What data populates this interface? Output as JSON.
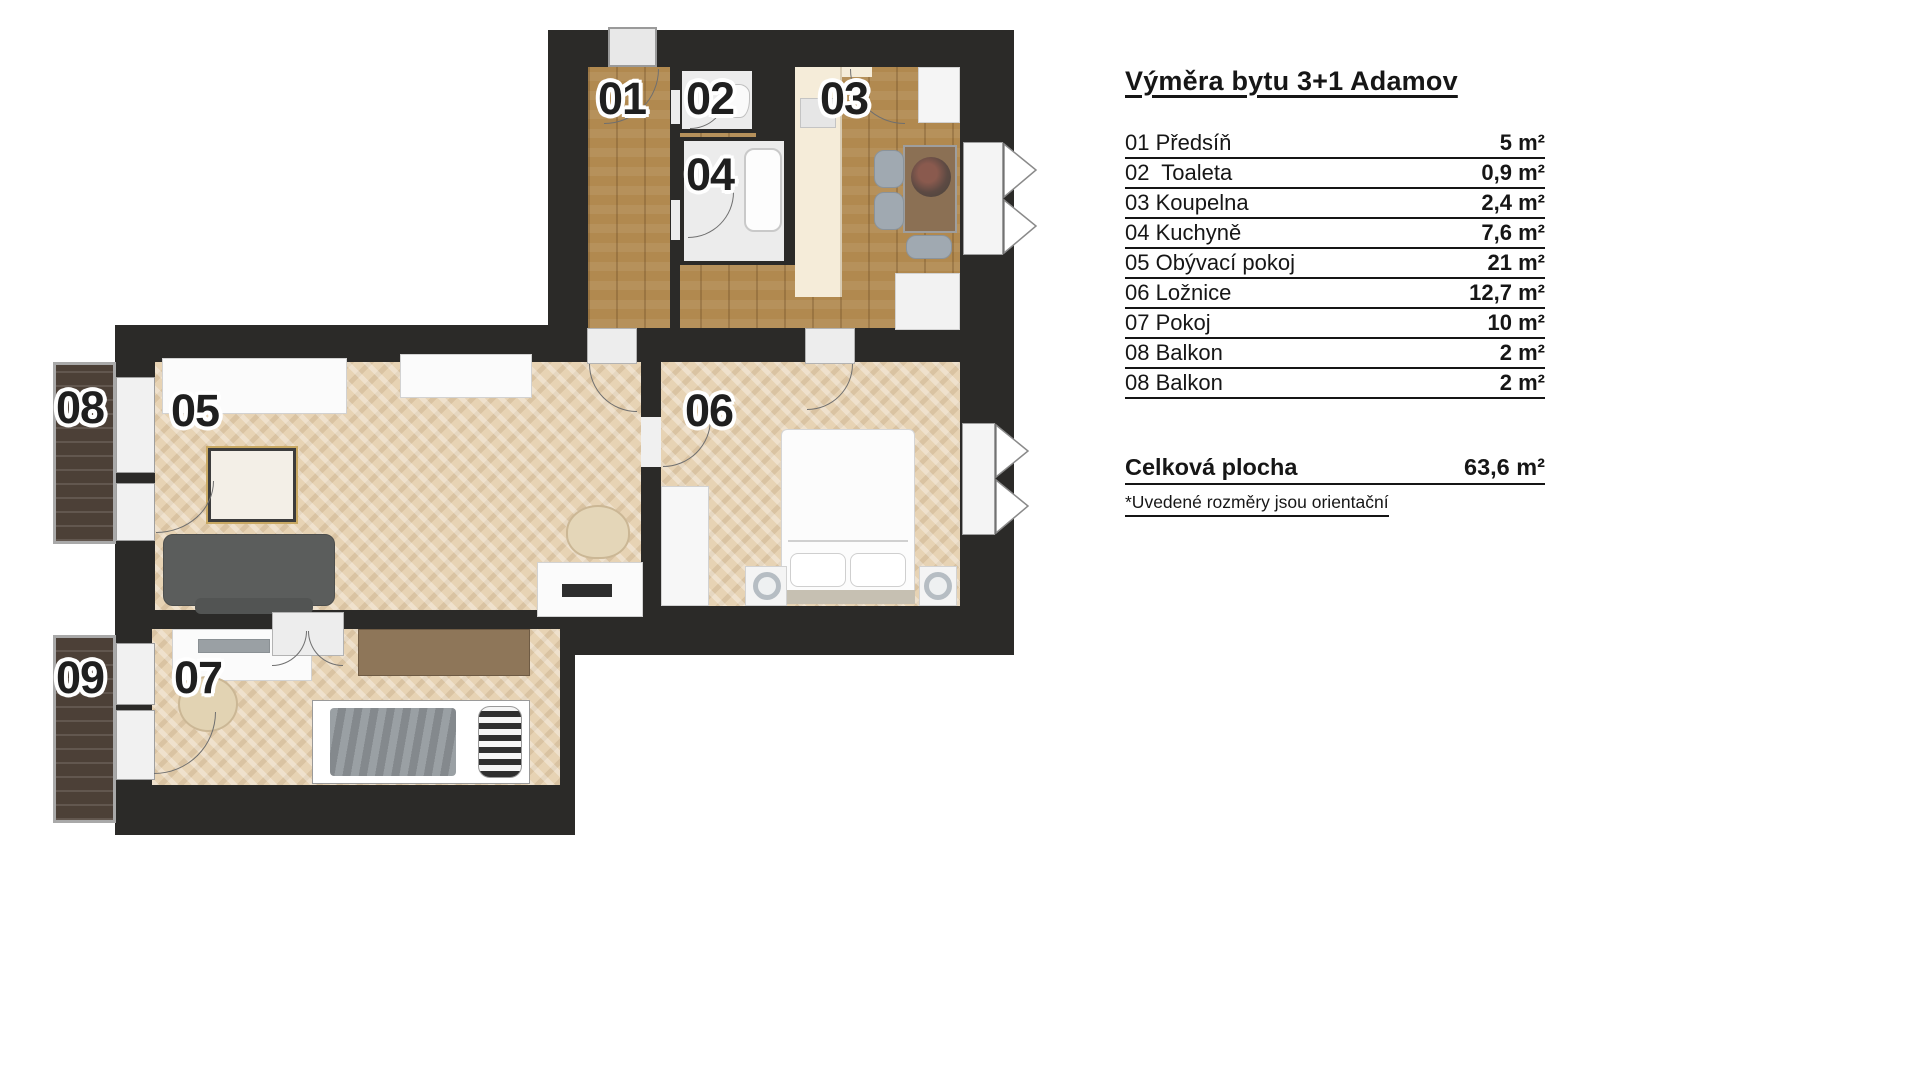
{
  "legend": {
    "title": "Výměra bytu 3+1 Adamov",
    "rows": [
      {
        "label": "01 Předsíň",
        "value": "5 m²"
      },
      {
        "label": "02  Toaleta",
        "value": "0,9 m²"
      },
      {
        "label": "03 Koupelna",
        "value": "2,4 m²"
      },
      {
        "label": "04 Kuchyně",
        "value": "7,6 m²"
      },
      {
        "label": "05 Obývací pokoj",
        "value": "21 m²"
      },
      {
        "label": "06 Ložnice",
        "value": "12,7 m²"
      },
      {
        "label": "07 Pokoj",
        "value": "10 m²"
      },
      {
        "label": "08 Balkon",
        "value": "2 m²"
      },
      {
        "label": "08 Balkon",
        "value": "2 m²"
      }
    ],
    "total": {
      "label": "Celková plocha",
      "value": "63,6 m²"
    },
    "note": "*Uvedené rozměry jsou orientační"
  },
  "plan": {
    "room_labels": [
      "01",
      "02",
      "03",
      "04",
      "05",
      "06",
      "07",
      "08",
      "09"
    ],
    "colors": {
      "wall": "#2b2a28",
      "oak_floor": "#b1894f",
      "parquet_floor": "#e7d3b4",
      "balcony_deck": "#4c4037",
      "wet_room": "#ececec",
      "kitchen_counter": "#f5ecd9"
    }
  }
}
